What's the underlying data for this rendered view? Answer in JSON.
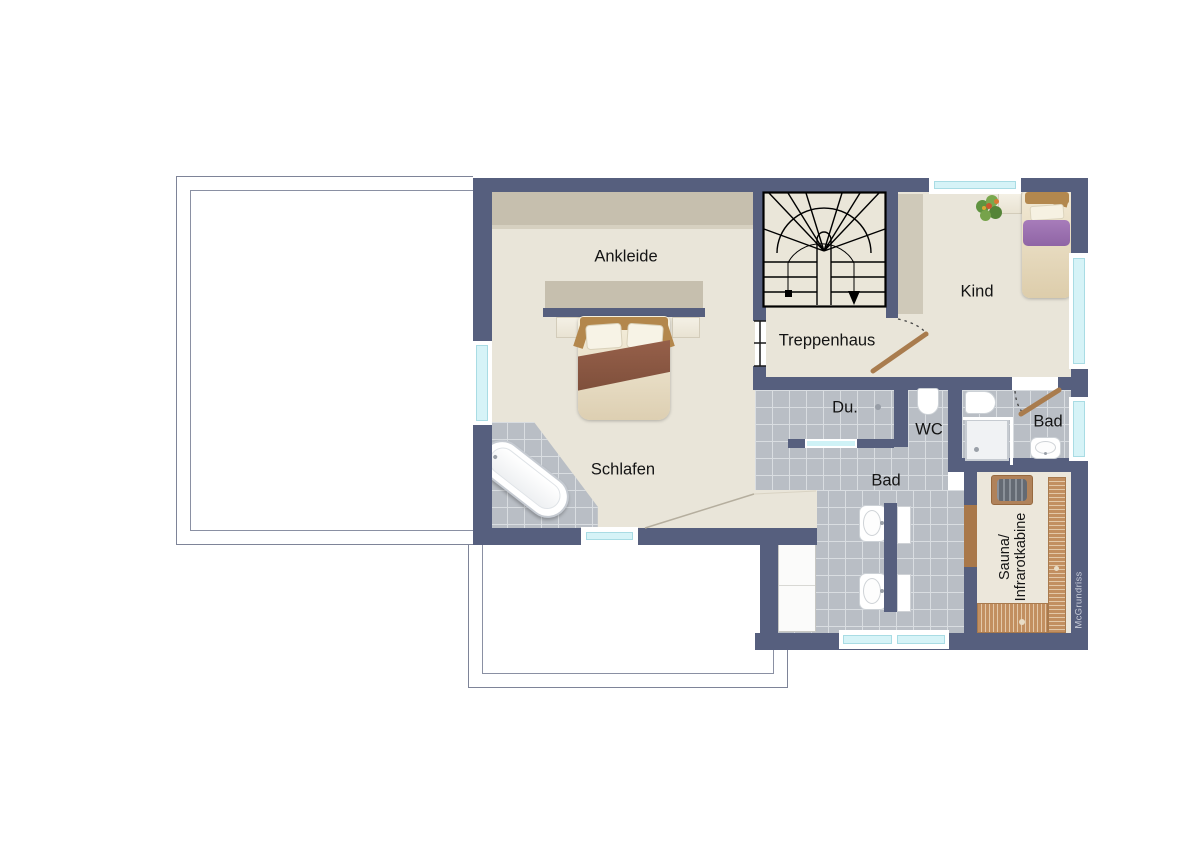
{
  "rooms": {
    "ankleide": "Ankleide",
    "treppenhaus": "Treppenhaus",
    "kind": "Kind",
    "schlafen": "Schlafen",
    "du": "Du.",
    "wc": "WC",
    "bad_small": "Bad",
    "bad_main": "Bad",
    "sauna": "Sauna/\nInfrarotkabine"
  },
  "watermark": "McGrundriss",
  "colors": {
    "wall": "#565f7e",
    "floor": "#e9e5d9",
    "tile": "#b9bec5",
    "window_glass": "#d6f3f7",
    "wood": "#b3874c",
    "sauna_bench": "#c28f60",
    "blanket_purple": "#9a6fb0",
    "blanket_brown": "#8a5741"
  },
  "fixtures": {
    "double_bed": "double bed",
    "single_bed": "single bed",
    "bathtub": "bathtub",
    "shower": "shower",
    "toilet": "toilet",
    "washbasin": "washbasin",
    "sauna_heater": "sauna heater",
    "plant": "plant",
    "wardrobe": "wardrobe",
    "stairs": "stairs"
  }
}
